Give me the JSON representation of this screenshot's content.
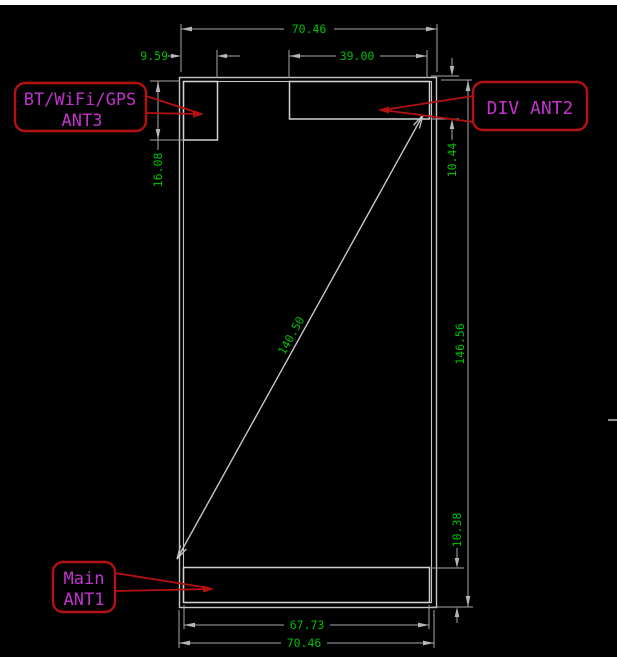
{
  "colors": {
    "bg": "#000000",
    "topbar": "#ffffff",
    "outline": "#c6c6c6",
    "antline": "#d2d2d2",
    "dim": "#a8a8a8",
    "arrow": "#b5b5b5",
    "green": "#00c000",
    "magenta": "#c233cc",
    "red": "#b51111",
    "tick": "#8a8a8a"
  },
  "dimensions": {
    "top_width": "70.46",
    "ant3_width": "9.59",
    "ant2_width": "39.00",
    "ant3_height": "16.08",
    "ant2_height": "10.44",
    "diagonal": "140.50",
    "body_height": "146.56",
    "ant1_height": "10.38",
    "ant1_width": "67.73",
    "bottom_width": "70.46"
  },
  "callouts": {
    "ant3": {
      "line1": "BT/WiFi/GPS",
      "line2": "ANT3"
    },
    "ant2": {
      "label": "DIV ANT2"
    },
    "ant1": {
      "line1": "Main",
      "line2": "ANT1"
    }
  }
}
